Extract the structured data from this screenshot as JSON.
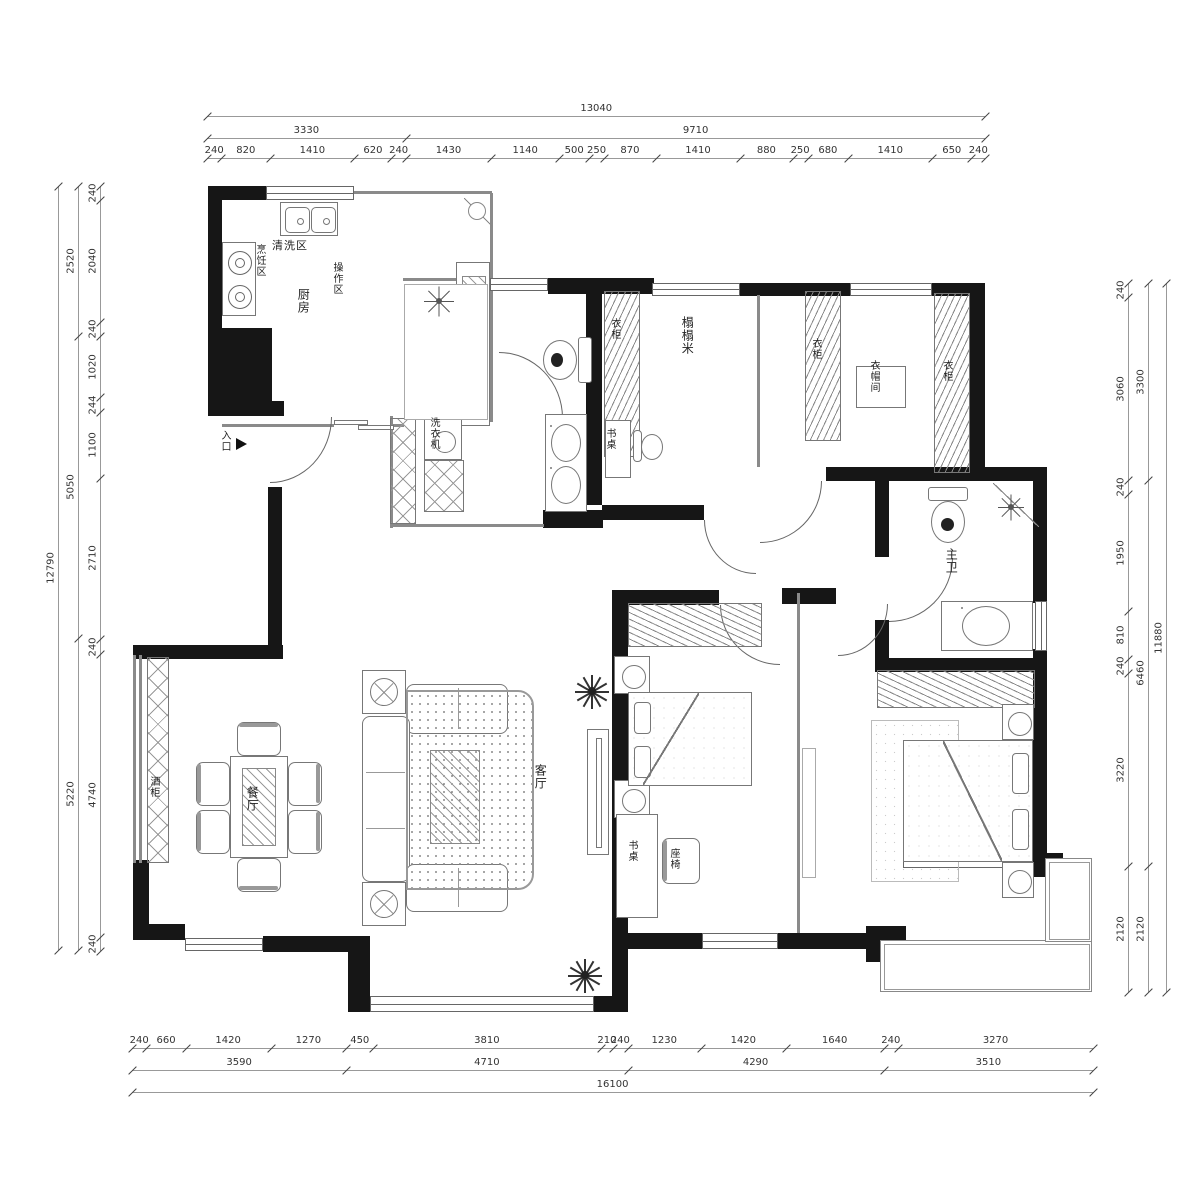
{
  "meta": {
    "title": "apartment-floor-plan"
  },
  "accent_colors": {
    "wall": "#161616",
    "line": "#777777",
    "dim_text": "#333333"
  },
  "scale_px_per_mm": 0.0597,
  "dimensions": {
    "sides": [
      {
        "name": "top",
        "orient": "h",
        "origin": 207,
        "rows": [
          {
            "pos": 116,
            "v": [
              13040
            ]
          },
          {
            "pos": 138,
            "v": [
              3330,
              9710
            ]
          },
          {
            "pos": 158,
            "v": [
              240,
              820,
              1410,
              620,
              240,
              1430,
              1140,
              500,
              250,
              870,
              1410,
              880,
              250,
              680,
              1410,
              650,
              240
            ]
          }
        ]
      },
      {
        "name": "bottom",
        "orient": "h",
        "origin": 132,
        "rows": [
          {
            "pos": 1048,
            "v": [
              240,
              660,
              1420,
              1270,
              450,
              3810,
              210,
              240,
              1230,
              1420,
              1640,
              240,
              3270
            ]
          },
          {
            "pos": 1070,
            "v": [
              3590,
              4710,
              4290,
              3510
            ]
          },
          {
            "pos": 1092,
            "v": [
              16100
            ]
          }
        ]
      },
      {
        "name": "left",
        "orient": "v",
        "origin": 186,
        "rows": [
          {
            "pos": 100,
            "v": [
              240,
              2040,
              240,
              1020,
              244,
              1100,
              2710,
              240,
              4740,
              240
            ]
          },
          {
            "pos": 78,
            "v": [
              2520,
              5050,
              5220
            ]
          },
          {
            "pos": 58,
            "v": [
              12790
            ]
          }
        ]
      },
      {
        "name": "right",
        "orient": "v",
        "origin": 283,
        "rows": [
          {
            "pos": 1128,
            "v": [
              240,
              3060,
              240,
              1950,
              810,
              240,
              3220,
              2120
            ]
          },
          {
            "pos": 1148,
            "v": [
              3300,
              6460,
              2120
            ]
          },
          {
            "pos": 1166,
            "v": [
              11880
            ]
          }
        ]
      }
    ]
  },
  "room_labels": [
    {
      "text": "清洗区",
      "x": 272,
      "y": 240,
      "v": false,
      "s": 11,
      "n": "label-washing-zone"
    },
    {
      "text": "烹饪区",
      "x": 254,
      "y": 244,
      "v": true,
      "s": 10,
      "n": "label-cooking-zone"
    },
    {
      "text": "厨房",
      "x": 296,
      "y": 288,
      "v": true,
      "s": 12,
      "n": "label-kitchen"
    },
    {
      "text": "操作区",
      "x": 331,
      "y": 262,
      "v": true,
      "s": 10,
      "n": "label-prep-zone"
    },
    {
      "text": "入口",
      "x": 219,
      "y": 430,
      "v": true,
      "s": 10,
      "n": "label-entrance"
    },
    {
      "text": "洗衣机",
      "x": 428,
      "y": 417,
      "v": true,
      "s": 10,
      "n": "label-washing-machine"
    },
    {
      "text": "衣柜",
      "x": 609,
      "y": 318,
      "v": true,
      "s": 10,
      "n": "label-wardrobe-tatami"
    },
    {
      "text": "榻榻米",
      "x": 680,
      "y": 316,
      "v": true,
      "s": 12,
      "n": "label-tatami-room"
    },
    {
      "text": "书桌",
      "x": 604,
      "y": 428,
      "v": true,
      "s": 10,
      "n": "label-desk-tatami"
    },
    {
      "text": "衣柜",
      "x": 810,
      "y": 338,
      "v": true,
      "s": 10,
      "n": "label-wardrobe-cloak-west"
    },
    {
      "text": "衣帽间",
      "x": 868,
      "y": 360,
      "v": true,
      "s": 10,
      "n": "label-cloakroom"
    },
    {
      "text": "衣柜",
      "x": 941,
      "y": 360,
      "v": true,
      "s": 10,
      "n": "label-wardrobe-cloak-east"
    },
    {
      "text": "主卫",
      "x": 944,
      "y": 548,
      "v": true,
      "s": 12,
      "n": "label-master-bath"
    },
    {
      "text": "客厅",
      "x": 533,
      "y": 764,
      "v": true,
      "s": 12,
      "n": "label-living-room"
    },
    {
      "text": "餐厅",
      "x": 245,
      "y": 786,
      "v": true,
      "s": 12,
      "n": "label-dining-room"
    },
    {
      "text": "酒柜",
      "x": 148,
      "y": 776,
      "v": true,
      "s": 10,
      "n": "label-wine-cabinet"
    },
    {
      "text": "书桌",
      "x": 626,
      "y": 840,
      "v": true,
      "s": 10,
      "n": "label-desk-bedroom2"
    },
    {
      "text": "座椅",
      "x": 668,
      "y": 848,
      "v": true,
      "s": 10,
      "n": "label-chair-bedroom2"
    }
  ],
  "walls": [
    [
      208,
      186,
      58,
      14
    ],
    [
      208,
      186,
      14,
      150
    ],
    [
      208,
      328,
      64,
      88
    ],
    [
      208,
      401,
      76,
      15
    ],
    [
      268,
      487,
      14,
      160
    ],
    [
      133,
      645,
      150,
      14
    ],
    [
      133,
      860,
      16,
      80
    ],
    [
      133,
      924,
      52,
      16
    ],
    [
      263,
      936,
      107,
      16
    ],
    [
      348,
      936,
      22,
      76
    ],
    [
      594,
      996,
      34,
      16
    ],
    [
      612,
      593,
      16,
      419
    ],
    [
      628,
      933,
      74,
      16
    ],
    [
      778,
      933,
      94,
      16
    ],
    [
      866,
      926,
      40,
      36
    ],
    [
      586,
      283,
      16,
      222
    ],
    [
      602,
      505,
      102,
      15
    ],
    [
      826,
      467,
      221,
      14
    ],
    [
      969,
      283,
      16,
      190
    ],
    [
      548,
      278,
      106,
      16
    ],
    [
      740,
      283,
      110,
      13
    ],
    [
      932,
      283,
      52,
      13
    ],
    [
      875,
      481,
      14,
      76
    ],
    [
      875,
      620,
      14,
      38
    ],
    [
      1033,
      481,
      14,
      122
    ],
    [
      1033,
      649,
      14,
      23
    ],
    [
      875,
      658,
      172,
      14
    ],
    [
      782,
      588,
      54,
      16
    ],
    [
      612,
      590,
      107,
      15
    ],
    [
      1033,
      658,
      14,
      200
    ],
    [
      1033,
      853,
      30,
      24
    ],
    [
      543,
      510,
      60,
      18
    ]
  ],
  "thin_walls": [
    [
      354,
      191,
      138,
      3
    ],
    [
      490,
      193,
      3,
      88
    ],
    [
      403,
      278,
      88,
      3
    ],
    [
      222,
      424,
      112,
      3
    ],
    [
      392,
      424,
      12,
      3
    ],
    [
      490,
      282,
      3,
      140
    ],
    [
      390,
      416,
      3,
      112
    ],
    [
      390,
      524,
      154,
      3
    ],
    [
      133,
      655,
      3,
      208
    ],
    [
      139,
      655,
      3,
      208
    ],
    [
      757,
      295,
      3,
      172
    ],
    [
      797,
      593,
      3,
      340
    ]
  ],
  "windows": [
    [
      266,
      186,
      88,
      14
    ],
    [
      652,
      283,
      88,
      13
    ],
    [
      850,
      283,
      82,
      13
    ],
    [
      1035,
      601,
      12,
      50
    ],
    [
      903,
      854,
      130,
      14
    ],
    [
      702,
      933,
      76,
      16
    ],
    [
      370,
      996,
      224,
      16
    ],
    [
      185,
      938,
      78,
      13
    ],
    [
      490,
      278,
      58,
      13
    ]
  ],
  "balconies": [
    [
      880,
      940,
      212,
      52
    ],
    [
      1045,
      858,
      47,
      84
    ]
  ],
  "doors": [
    {
      "x": 270,
      "y": 417,
      "w": 62,
      "h": 66,
      "c": "br",
      "n": "entry-door-arc"
    },
    {
      "x": 499,
      "y": 352,
      "w": 64,
      "h": 66,
      "c": "tr",
      "n": "bath-door-arc"
    },
    {
      "x": 704,
      "y": 520,
      "w": 52,
      "h": 54,
      "c": "bl",
      "n": "tatami-door-arc"
    },
    {
      "x": 760,
      "y": 481,
      "w": 62,
      "h": 62,
      "c": "br",
      "n": "cloakroom-door-arc"
    },
    {
      "x": 720,
      "y": 605,
      "w": 60,
      "h": 60,
      "c": "bl",
      "n": "bedroom2-door-arc"
    },
    {
      "x": 838,
      "y": 604,
      "w": 50,
      "h": 52,
      "c": "br",
      "n": "master-bedroom-door-arc"
    },
    {
      "x": 889,
      "y": 558,
      "w": 64,
      "h": 64,
      "c": "br",
      "n": "master-bath-door-arc"
    }
  ],
  "furniture": [
    {
      "t": "sink2",
      "x": 280,
      "y": 202,
      "w": 58,
      "h": 34,
      "n": "kitchen-sink"
    },
    {
      "t": "stove",
      "x": 222,
      "y": 242,
      "w": 34,
      "h": 74,
      "n": "stove"
    },
    {
      "t": "rect",
      "x": 456,
      "y": 262,
      "w": 34,
      "h": 164,
      "n": "kitchen-counter"
    },
    {
      "t": "hatchdiag",
      "x": 462,
      "y": 276,
      "w": 24,
      "h": 46,
      "n": "cutting-board"
    },
    {
      "t": "diag",
      "x": 464,
      "y": 198,
      "w": 28,
      "h": 28,
      "d": "bl",
      "n": "kitchen-corner"
    },
    {
      "t": "circ",
      "x": 468,
      "y": 202,
      "w": 18,
      "h": 18,
      "n": "kitchen-corner-circle"
    },
    {
      "t": "slide",
      "x": 334,
      "y": 420,
      "w": 58,
      "h": 9,
      "n": "kitchen-sliding-door"
    },
    {
      "t": "hatchx",
      "x": 390,
      "y": 418,
      "w": 26,
      "h": 106,
      "n": "utility-cabinet"
    },
    {
      "t": "washer",
      "x": 424,
      "y": 416,
      "w": 38,
      "h": 44,
      "n": "washing-machine"
    },
    {
      "t": "hatchx",
      "x": 424,
      "y": 460,
      "w": 40,
      "h": 52,
      "n": "utility-cabinet-2"
    },
    {
      "t": "lightrect",
      "x": 404,
      "y": 284,
      "w": 84,
      "h": 136,
      "n": "shower-room-floor"
    },
    {
      "t": "star",
      "x": 424,
      "y": 286,
      "w": 30,
      "h": 30,
      "n": "shower-head-icon"
    },
    {
      "t": "toilet",
      "x": 541,
      "y": 333,
      "w": 50,
      "h": 54,
      "d": "l",
      "n": "toilet"
    },
    {
      "t": "rect",
      "x": 545,
      "y": 414,
      "w": 42,
      "h": 98,
      "n": "bath-vanity"
    },
    {
      "t": "basin",
      "x": 551,
      "y": 424,
      "w": 30,
      "h": 38,
      "n": "basin-1"
    },
    {
      "t": "basin",
      "x": 551,
      "y": 466,
      "w": 30,
      "h": 38,
      "n": "basin-2"
    },
    {
      "t": "wrobe",
      "x": 604,
      "y": 291,
      "w": 36,
      "h": 166,
      "n": "wardrobe-tatami"
    },
    {
      "t": "rect",
      "x": 605,
      "y": 420,
      "w": 26,
      "h": 58,
      "n": "desk-tatami"
    },
    {
      "t": "chairo",
      "x": 633,
      "y": 426,
      "w": 38,
      "h": 44,
      "n": "office-chair"
    },
    {
      "t": "wrobe",
      "x": 805,
      "y": 291,
      "w": 36,
      "h": 150,
      "n": "wardrobe-cloak-west"
    },
    {
      "t": "wrobe",
      "x": 934,
      "y": 293,
      "w": 36,
      "h": 180,
      "n": "wardrobe-cloak-east"
    },
    {
      "t": "rect",
      "x": 856,
      "y": 366,
      "w": 50,
      "h": 42,
      "n": "cloakroom-island"
    },
    {
      "t": "toilet",
      "x": 924,
      "y": 487,
      "w": 48,
      "h": 58,
      "d": "d",
      "n": "master-toilet"
    },
    {
      "t": "diag",
      "x": 993,
      "y": 483,
      "w": 46,
      "h": 44,
      "d": "bl",
      "n": "master-shower-corner"
    },
    {
      "t": "star",
      "x": 998,
      "y": 494,
      "w": 26,
      "h": 26,
      "n": "master-shower-head-icon"
    },
    {
      "t": "rect",
      "x": 941,
      "y": 601,
      "w": 92,
      "h": 50,
      "n": "master-vanity"
    },
    {
      "t": "basin",
      "x": 962,
      "y": 606,
      "w": 48,
      "h": 40,
      "n": "master-basin"
    },
    {
      "t": "rect",
      "x": 362,
      "y": 670,
      "w": 44,
      "h": 44,
      "n": "side-table-1"
    },
    {
      "t": "lamp",
      "x": 370,
      "y": 678,
      "w": 28,
      "h": 28,
      "n": "lamp-1"
    },
    {
      "t": "sofa",
      "x": 406,
      "y": 684,
      "w": 102,
      "h": 50,
      "n": "sofa-top"
    },
    {
      "t": "sofa",
      "x": 362,
      "y": 716,
      "w": 48,
      "h": 166,
      "n": "sofa-main"
    },
    {
      "t": "sofa",
      "x": 406,
      "y": 864,
      "w": 102,
      "h": 48,
      "n": "sofa-bottom"
    },
    {
      "t": "rect",
      "x": 362,
      "y": 882,
      "w": 44,
      "h": 44,
      "n": "side-table-2"
    },
    {
      "t": "lamp",
      "x": 370,
      "y": 890,
      "w": 28,
      "h": 28,
      "n": "lamp-2"
    },
    {
      "t": "rugdots",
      "x": 406,
      "y": 690,
      "w": 128,
      "h": 200,
      "n": "living-rug"
    },
    {
      "t": "hatchdiag",
      "x": 430,
      "y": 750,
      "w": 50,
      "h": 94,
      "n": "coffee-table"
    },
    {
      "t": "tv",
      "x": 587,
      "y": 729,
      "w": 22,
      "h": 126,
      "n": "tv-cabinet"
    },
    {
      "t": "plant",
      "x": 575,
      "y": 674,
      "w": 34,
      "h": 34,
      "n": "plant-1"
    },
    {
      "t": "plant",
      "x": 568,
      "y": 958,
      "w": 34,
      "h": 34,
      "n": "plant-2"
    },
    {
      "t": "hatchx",
      "x": 147,
      "y": 657,
      "w": 22,
      "h": 206,
      "n": "wine-cabinet"
    },
    {
      "t": "rect",
      "x": 230,
      "y": 756,
      "w": 58,
      "h": 102,
      "n": "dining-table"
    },
    {
      "t": "hatchdiag",
      "x": 242,
      "y": 768,
      "w": 34,
      "h": 78,
      "n": "dining-table-runner"
    },
    {
      "t": "chairc",
      "x": 237,
      "y": 722,
      "w": 44,
      "h": 34,
      "d": "t",
      "n": "dining-chair-n"
    },
    {
      "t": "chairc",
      "x": 237,
      "y": 858,
      "w": 44,
      "h": 34,
      "d": "b",
      "n": "dining-chair-s"
    },
    {
      "t": "chairc",
      "x": 196,
      "y": 762,
      "w": 34,
      "h": 44,
      "d": "l",
      "n": "dining-chair-w1"
    },
    {
      "t": "chairc",
      "x": 196,
      "y": 810,
      "w": 34,
      "h": 44,
      "d": "l",
      "n": "dining-chair-w2"
    },
    {
      "t": "chairc",
      "x": 288,
      "y": 762,
      "w": 34,
      "h": 44,
      "d": "r",
      "n": "dining-chair-e1"
    },
    {
      "t": "chairc",
      "x": 288,
      "y": 810,
      "w": 34,
      "h": 44,
      "d": "r",
      "n": "dining-chair-e2"
    },
    {
      "t": "wrobeh",
      "x": 628,
      "y": 603,
      "w": 134,
      "h": 44,
      "n": "wardrobe-bedroom2"
    },
    {
      "t": "lampbox",
      "x": 614,
      "y": 656,
      "w": 36,
      "h": 38,
      "n": "nightstand-b2-n"
    },
    {
      "t": "lampbox",
      "x": 614,
      "y": 780,
      "w": 36,
      "h": 38,
      "n": "nightstand-b2-s"
    },
    {
      "t": "bed",
      "x": 628,
      "y": 692,
      "w": 124,
      "h": 94,
      "d": "l",
      "n": "bed-bedroom2"
    },
    {
      "t": "rect",
      "x": 616,
      "y": 814,
      "w": 42,
      "h": 104,
      "n": "desk-bedroom2"
    },
    {
      "t": "chairc",
      "x": 662,
      "y": 838,
      "w": 38,
      "h": 46,
      "d": "l",
      "n": "chair-bedroom2"
    },
    {
      "t": "lightrect",
      "x": 802,
      "y": 748,
      "w": 14,
      "h": 130,
      "n": "tv-panel-master"
    },
    {
      "t": "wrobeh",
      "x": 877,
      "y": 670,
      "w": 158,
      "h": 38,
      "n": "wardrobe-master"
    },
    {
      "t": "rugplain",
      "x": 871,
      "y": 720,
      "w": 88,
      "h": 162,
      "n": "master-rug"
    },
    {
      "t": "bed",
      "x": 903,
      "y": 740,
      "w": 130,
      "h": 122,
      "d": "r",
      "n": "bed-master"
    },
    {
      "t": "lampbox",
      "x": 1002,
      "y": 704,
      "w": 32,
      "h": 36,
      "n": "nightstand-m-n"
    },
    {
      "t": "lampbox",
      "x": 1002,
      "y": 862,
      "w": 32,
      "h": 36,
      "n": "nightstand-m-s"
    },
    {
      "t": "arrow",
      "x": 236,
      "y": 438,
      "w": 11,
      "h": 12,
      "n": "entry-arrow-icon"
    }
  ]
}
